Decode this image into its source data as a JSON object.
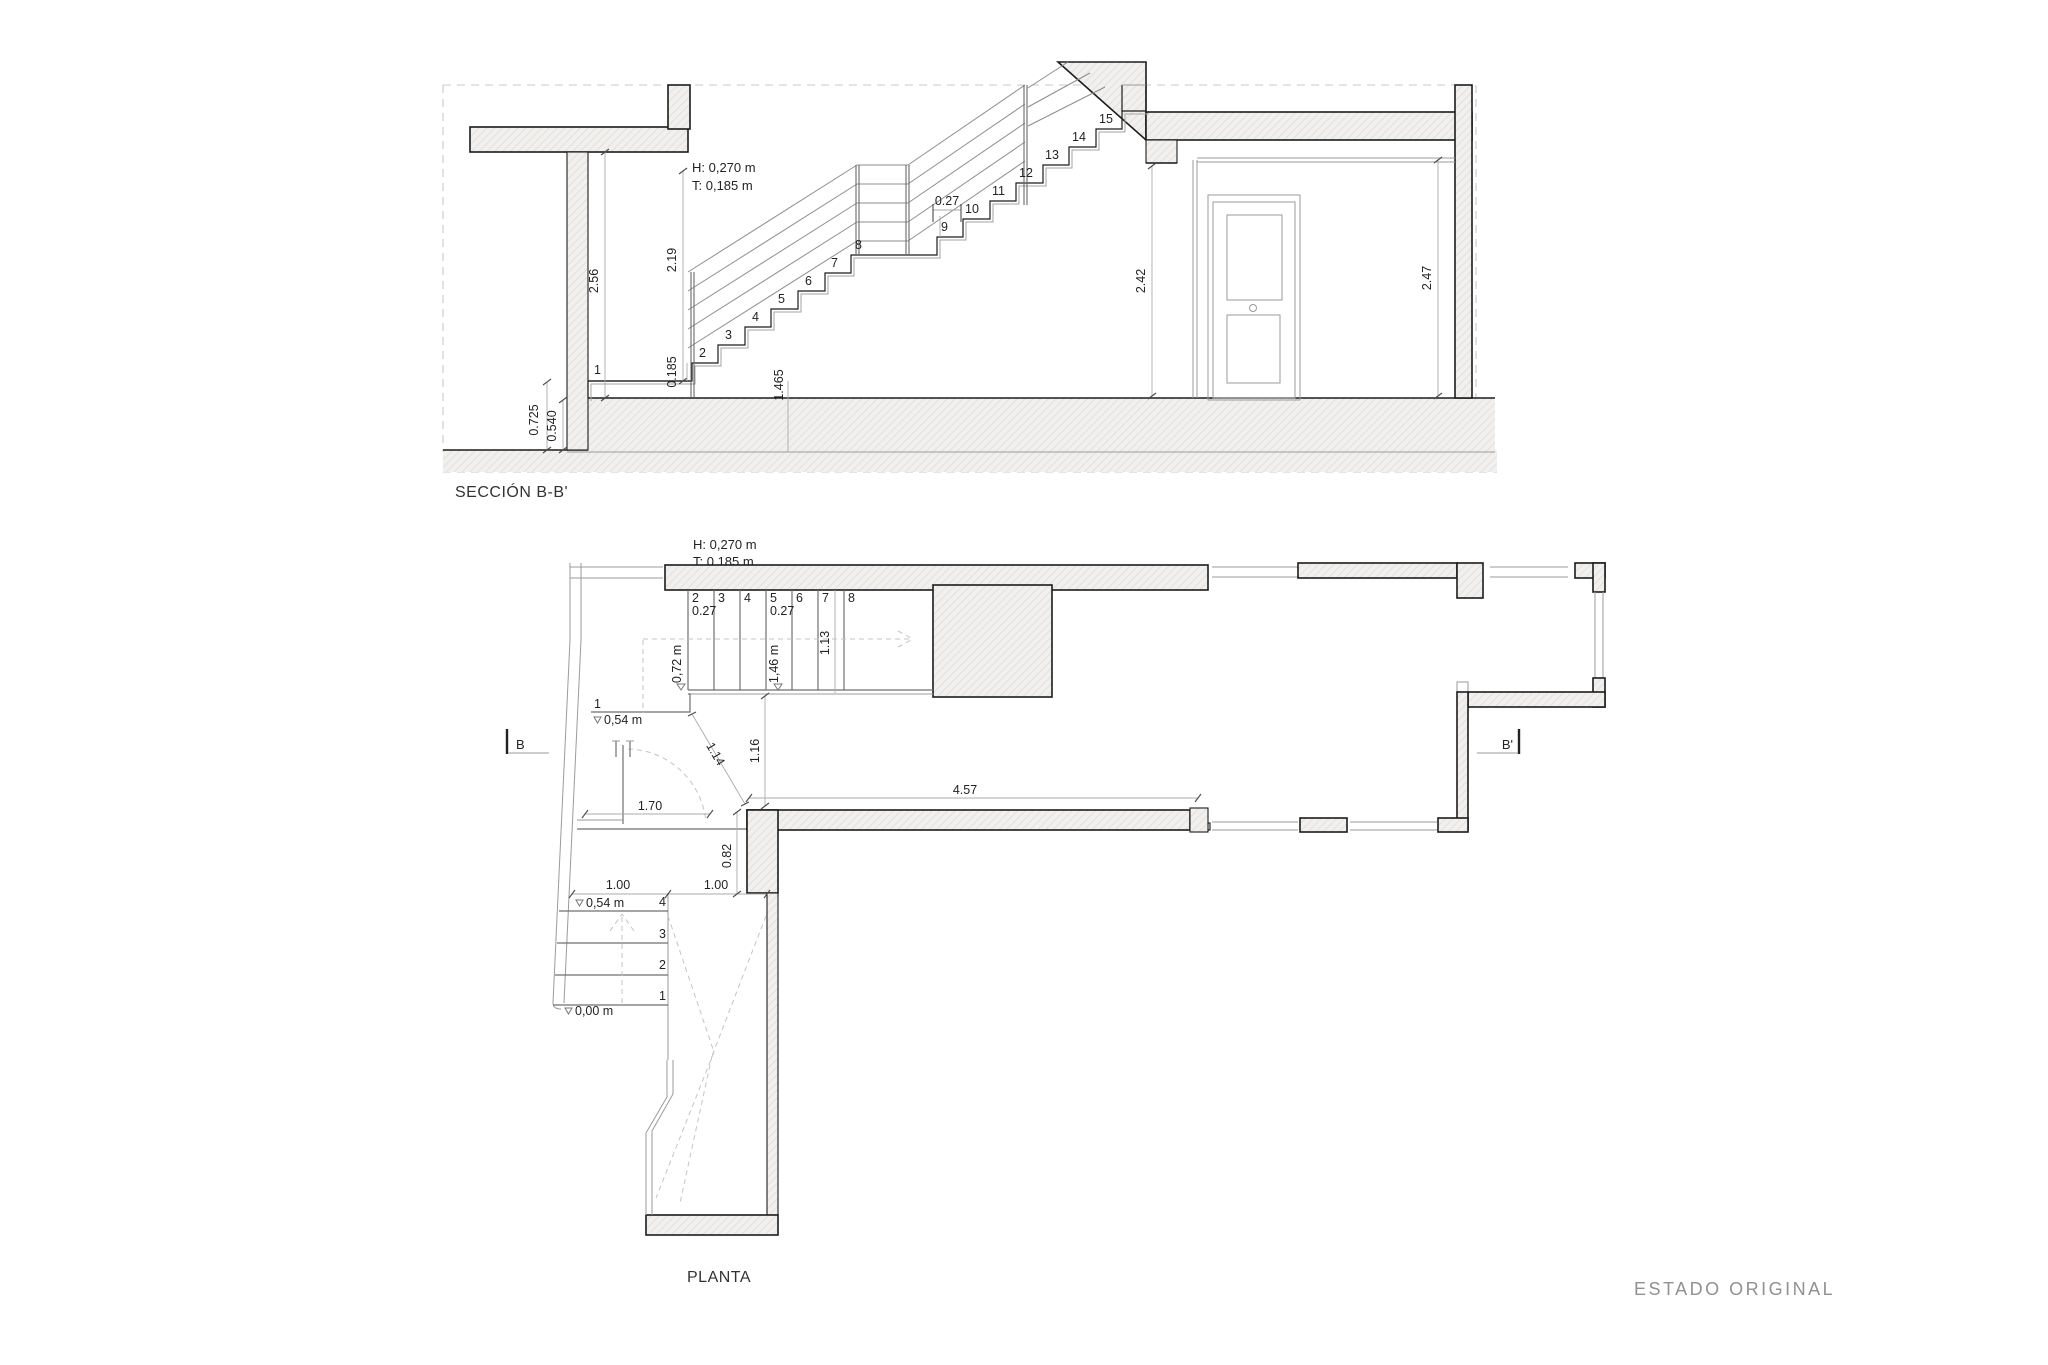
{
  "titles": {
    "section": "SECCIÓN B-B'",
    "plan": "PLANTA",
    "status": "ESTADO ORIGINAL"
  },
  "section": {
    "note_h": "H: 0,270 m",
    "note_t": "T: 0,185 m",
    "tread_width": "0.27",
    "steps": [
      "1",
      "2",
      "3",
      "4",
      "5",
      "6",
      "7",
      "8",
      "9",
      "10",
      "11",
      "12",
      "13",
      "14",
      "15"
    ],
    "dims": {
      "room_height_left": "2.56",
      "stair_headroom": "2.19",
      "first_riser": "0.185",
      "flight_run": "1.465",
      "door_wall_height": "2.42",
      "right_wall_height": "2.47",
      "foundation_left": "0.725",
      "foundation_right": "0.540"
    }
  },
  "plan": {
    "note_h": "H: 0,270 m",
    "note_t": "T: 0,185 m",
    "upper_steps": [
      "2",
      "3",
      "4",
      "5",
      "6",
      "7",
      "8"
    ],
    "tread_width_a": "0.27",
    "tread_width_b": "0.27",
    "first_step": "1",
    "lower_steps": [
      "4",
      "3",
      "2",
      "1"
    ],
    "levels": {
      "landing_mid": "0,72 m",
      "landing_top": "1,46 m",
      "entry_upper": "0,54 m",
      "entry_upper2": "0,54 m",
      "street": "0,00 m"
    },
    "dims": {
      "stair_width": "1.13",
      "hall_diag": "1.14",
      "hall_depth": "1.16",
      "corridor_length": "4.57",
      "hall_width": "1.70",
      "passage": "0.82",
      "steps_width": "1.00",
      "landing_width": "1.00"
    },
    "section_markers": {
      "start": "B",
      "end": "B'"
    }
  }
}
